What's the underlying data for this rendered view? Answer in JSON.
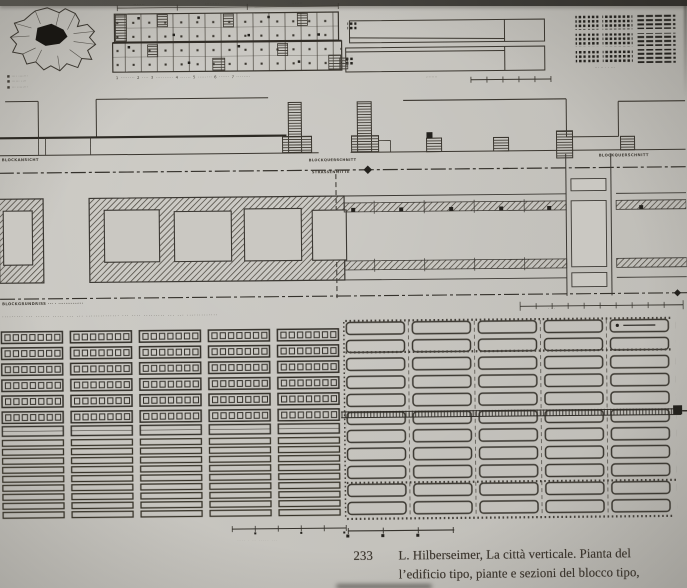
{
  "caption": {
    "number": "233",
    "line1": "L. Hilberseimer, La città verticale. Pianta del",
    "line2": "l’edificio tipo, piante e sezioni del blocco tipo,"
  },
  "labels": {
    "map_legend_1": "■ ···· ·······",
    "map_legend_2": "■ ······ ····",
    "map_legend_3": "■ ··· ········",
    "dim_1": "·······",
    "dim_2": "·········",
    "dim_3": "·······",
    "room_legend": "1 ········ 2 ···· 3 ·········· 4 ······ 5 ········ 6 ······ 7 ········",
    "roof_scale_label": "········",
    "keyplan_label": "··· ·· · · ···",
    "elev_left": "BLOCKANSICHT",
    "elev_mid": "··········",
    "elev_right": "BLOCKQUERSCHNITT",
    "mid_top": "BLOCKQUERSCHNITT",
    "mid_bottom": "STRASSENMITTE",
    "plan_left": "BLOCKGRUNDRISS ··· · ··············",
    "plan_scale_marks": "·   ·   ·",
    "siteplan_heading": "·········  ···  ······  ·····  ···  ···  ··············  ···  ····  ·········  ···  ···  ·············",
    "ghost_text": "···· · ·· ····· ···"
  },
  "colors": {
    "paper": "#c9c7c1",
    "ink": "#3a362f",
    "ink_heavy": "#2c2923",
    "black": "#23211d"
  }
}
